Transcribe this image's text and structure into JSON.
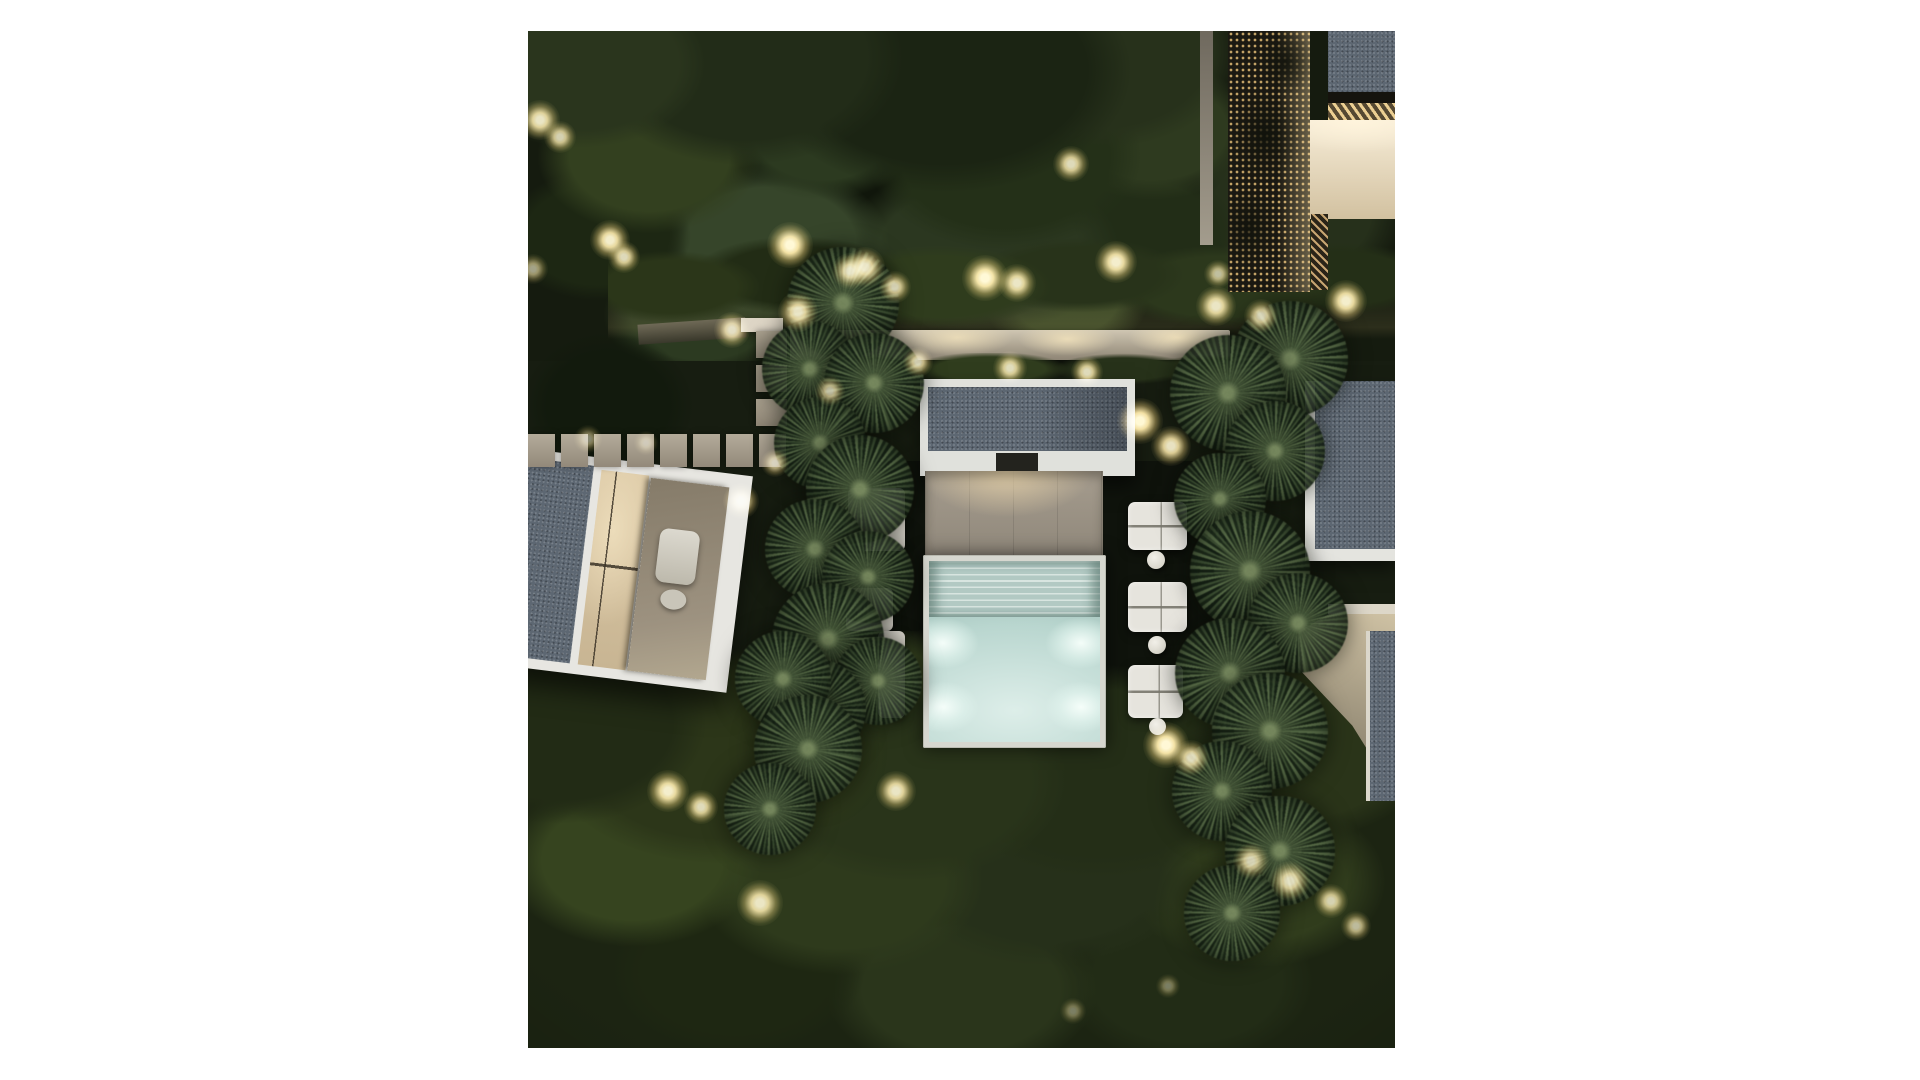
{
  "meta": {
    "type": "architectural-aerial-render",
    "time_of_day": "night",
    "description": "Top-down night render of a modern villa garden: central lit swimming pool with pavilion, gravel flat roofs, stone paver paths, rows of round palm trees, white sun loungers and warm landscape lighting, framed by dark tree canopy on a white page background",
    "canvas": {
      "page_w": 1920,
      "page_h": 1080,
      "photo_x": 528,
      "photo_y": 31,
      "photo_w": 867,
      "photo_h": 1017
    }
  },
  "palette": {
    "page_bg": "#ffffff",
    "night_base": "#171d11",
    "canopy_dark": "#141a0e",
    "canopy_mid": "#27311c",
    "canopy_light": "#3b4827",
    "warm_light": "#fff0bc",
    "gravel_roof": "#5d6772",
    "white_trim": "#e7e7e2",
    "terrace_taupe": "#9a9187",
    "pool_steps": "#b5ccc6",
    "pool_water": "#c2dcd6",
    "pool_glow": "#eefaf6",
    "beige_roof": "#8d8371",
    "window_warm": "#dbc9a8",
    "paver": "#a89f8e",
    "lit_wall": "#d2c9b6",
    "lattice_dot": "#caa86a",
    "lounger_white": "#e5e3dc",
    "palm_green": "#3d4f36"
  },
  "scene": {
    "garden_lights": [
      [
        12,
        89,
        40,
        0.9
      ],
      [
        32,
        106,
        32,
        0.8
      ],
      [
        82,
        209,
        40,
        0.95
      ],
      [
        96,
        226,
        32,
        0.85
      ],
      [
        204,
        299,
        36,
        0.85
      ],
      [
        262,
        214,
        46,
        1
      ],
      [
        270,
        281,
        40,
        0.9
      ],
      [
        322,
        240,
        36,
        0.85
      ],
      [
        337,
        236,
        40,
        0.9
      ],
      [
        367,
        256,
        32,
        0.8
      ],
      [
        457,
        247,
        46,
        1
      ],
      [
        489,
        252,
        38,
        0.9
      ],
      [
        543,
        133,
        36,
        0.85
      ],
      [
        588,
        231,
        42,
        0.95
      ],
      [
        688,
        275,
        40,
        0.9
      ],
      [
        733,
        285,
        34,
        0.8
      ],
      [
        818,
        270,
        42,
        0.95
      ],
      [
        690,
        243,
        28,
        0.7
      ],
      [
        612,
        390,
        46,
        1
      ],
      [
        643,
        415,
        40,
        0.9
      ],
      [
        390,
        331,
        30,
        0.8
      ],
      [
        482,
        337,
        34,
        0.85
      ],
      [
        559,
        341,
        32,
        0.85
      ],
      [
        302,
        360,
        30,
        0.7
      ],
      [
        213,
        470,
        36,
        0.85
      ],
      [
        247,
        432,
        28,
        0.7
      ],
      [
        638,
        714,
        46,
        1
      ],
      [
        663,
        727,
        36,
        0.85
      ],
      [
        140,
        760,
        42,
        0.95
      ],
      [
        173,
        776,
        34,
        0.85
      ],
      [
        368,
        760,
        40,
        0.9
      ],
      [
        232,
        872,
        46,
        0.9
      ],
      [
        723,
        830,
        36,
        0.8
      ],
      [
        762,
        850,
        40,
        0.85
      ],
      [
        803,
        870,
        34,
        0.8
      ],
      [
        828,
        895,
        30,
        0.7
      ],
      [
        60,
        408,
        28,
        0.5
      ],
      [
        118,
        412,
        24,
        0.45
      ],
      [
        5,
        238,
        30,
        0.6
      ],
      [
        545,
        980,
        26,
        0.4
      ],
      [
        640,
        955,
        24,
        0.4
      ]
    ],
    "palm_trees": [
      [
        315,
        272,
        56,
        10
      ],
      [
        282,
        338,
        48,
        80
      ],
      [
        346,
        352,
        50,
        160
      ],
      [
        292,
        412,
        46,
        40
      ],
      [
        332,
        458,
        54,
        200
      ],
      [
        287,
        518,
        50,
        120
      ],
      [
        340,
        546,
        46,
        300
      ],
      [
        300,
        608,
        56,
        60
      ],
      [
        350,
        650,
        44,
        240
      ],
      [
        288,
        678,
        50,
        20
      ],
      [
        255,
        648,
        48,
        180
      ],
      [
        280,
        718,
        54,
        100
      ],
      [
        242,
        778,
        46,
        260
      ],
      [
        762,
        328,
        58,
        30
      ],
      [
        700,
        362,
        58,
        140
      ],
      [
        747,
        420,
        50,
        220
      ],
      [
        692,
        468,
        46,
        70
      ],
      [
        722,
        540,
        60,
        310
      ],
      [
        770,
        592,
        50,
        170
      ],
      [
        702,
        642,
        55,
        250
      ],
      [
        742,
        700,
        58,
        90
      ],
      [
        694,
        760,
        50,
        330
      ],
      [
        752,
        820,
        55,
        200
      ],
      [
        704,
        882,
        48,
        45
      ]
    ],
    "walkway_pavers_horizontal": {
      "x0": 0,
      "y": 403,
      "count": 8,
      "w": 27,
      "h": 33,
      "gap": 6
    },
    "path_pavers_vertical": {
      "x": 228,
      "y0": 300,
      "count": 3,
      "w": 31,
      "h": 27,
      "gap": 7
    },
    "sun_loungers_right": [
      [
        600,
        471,
        59,
        48
      ],
      [
        600,
        551,
        59,
        50
      ],
      [
        600,
        634,
        55,
        53
      ]
    ],
    "side_tables": [
      [
        619,
        520,
        18
      ],
      [
        620,
        605,
        18
      ],
      [
        621,
        687,
        17
      ]
    ],
    "lounger_pads_left": [
      [
        320,
        457,
        57,
        63
      ],
      [
        318,
        557,
        47,
        43
      ],
      [
        350,
        600,
        27,
        87
      ]
    ],
    "underwater_light_glows": [
      [
        415,
        612
      ],
      [
        553,
        612
      ],
      [
        415,
        676
      ],
      [
        553,
        676
      ]
    ],
    "pool_glow_size": [
      92,
      66
    ]
  }
}
